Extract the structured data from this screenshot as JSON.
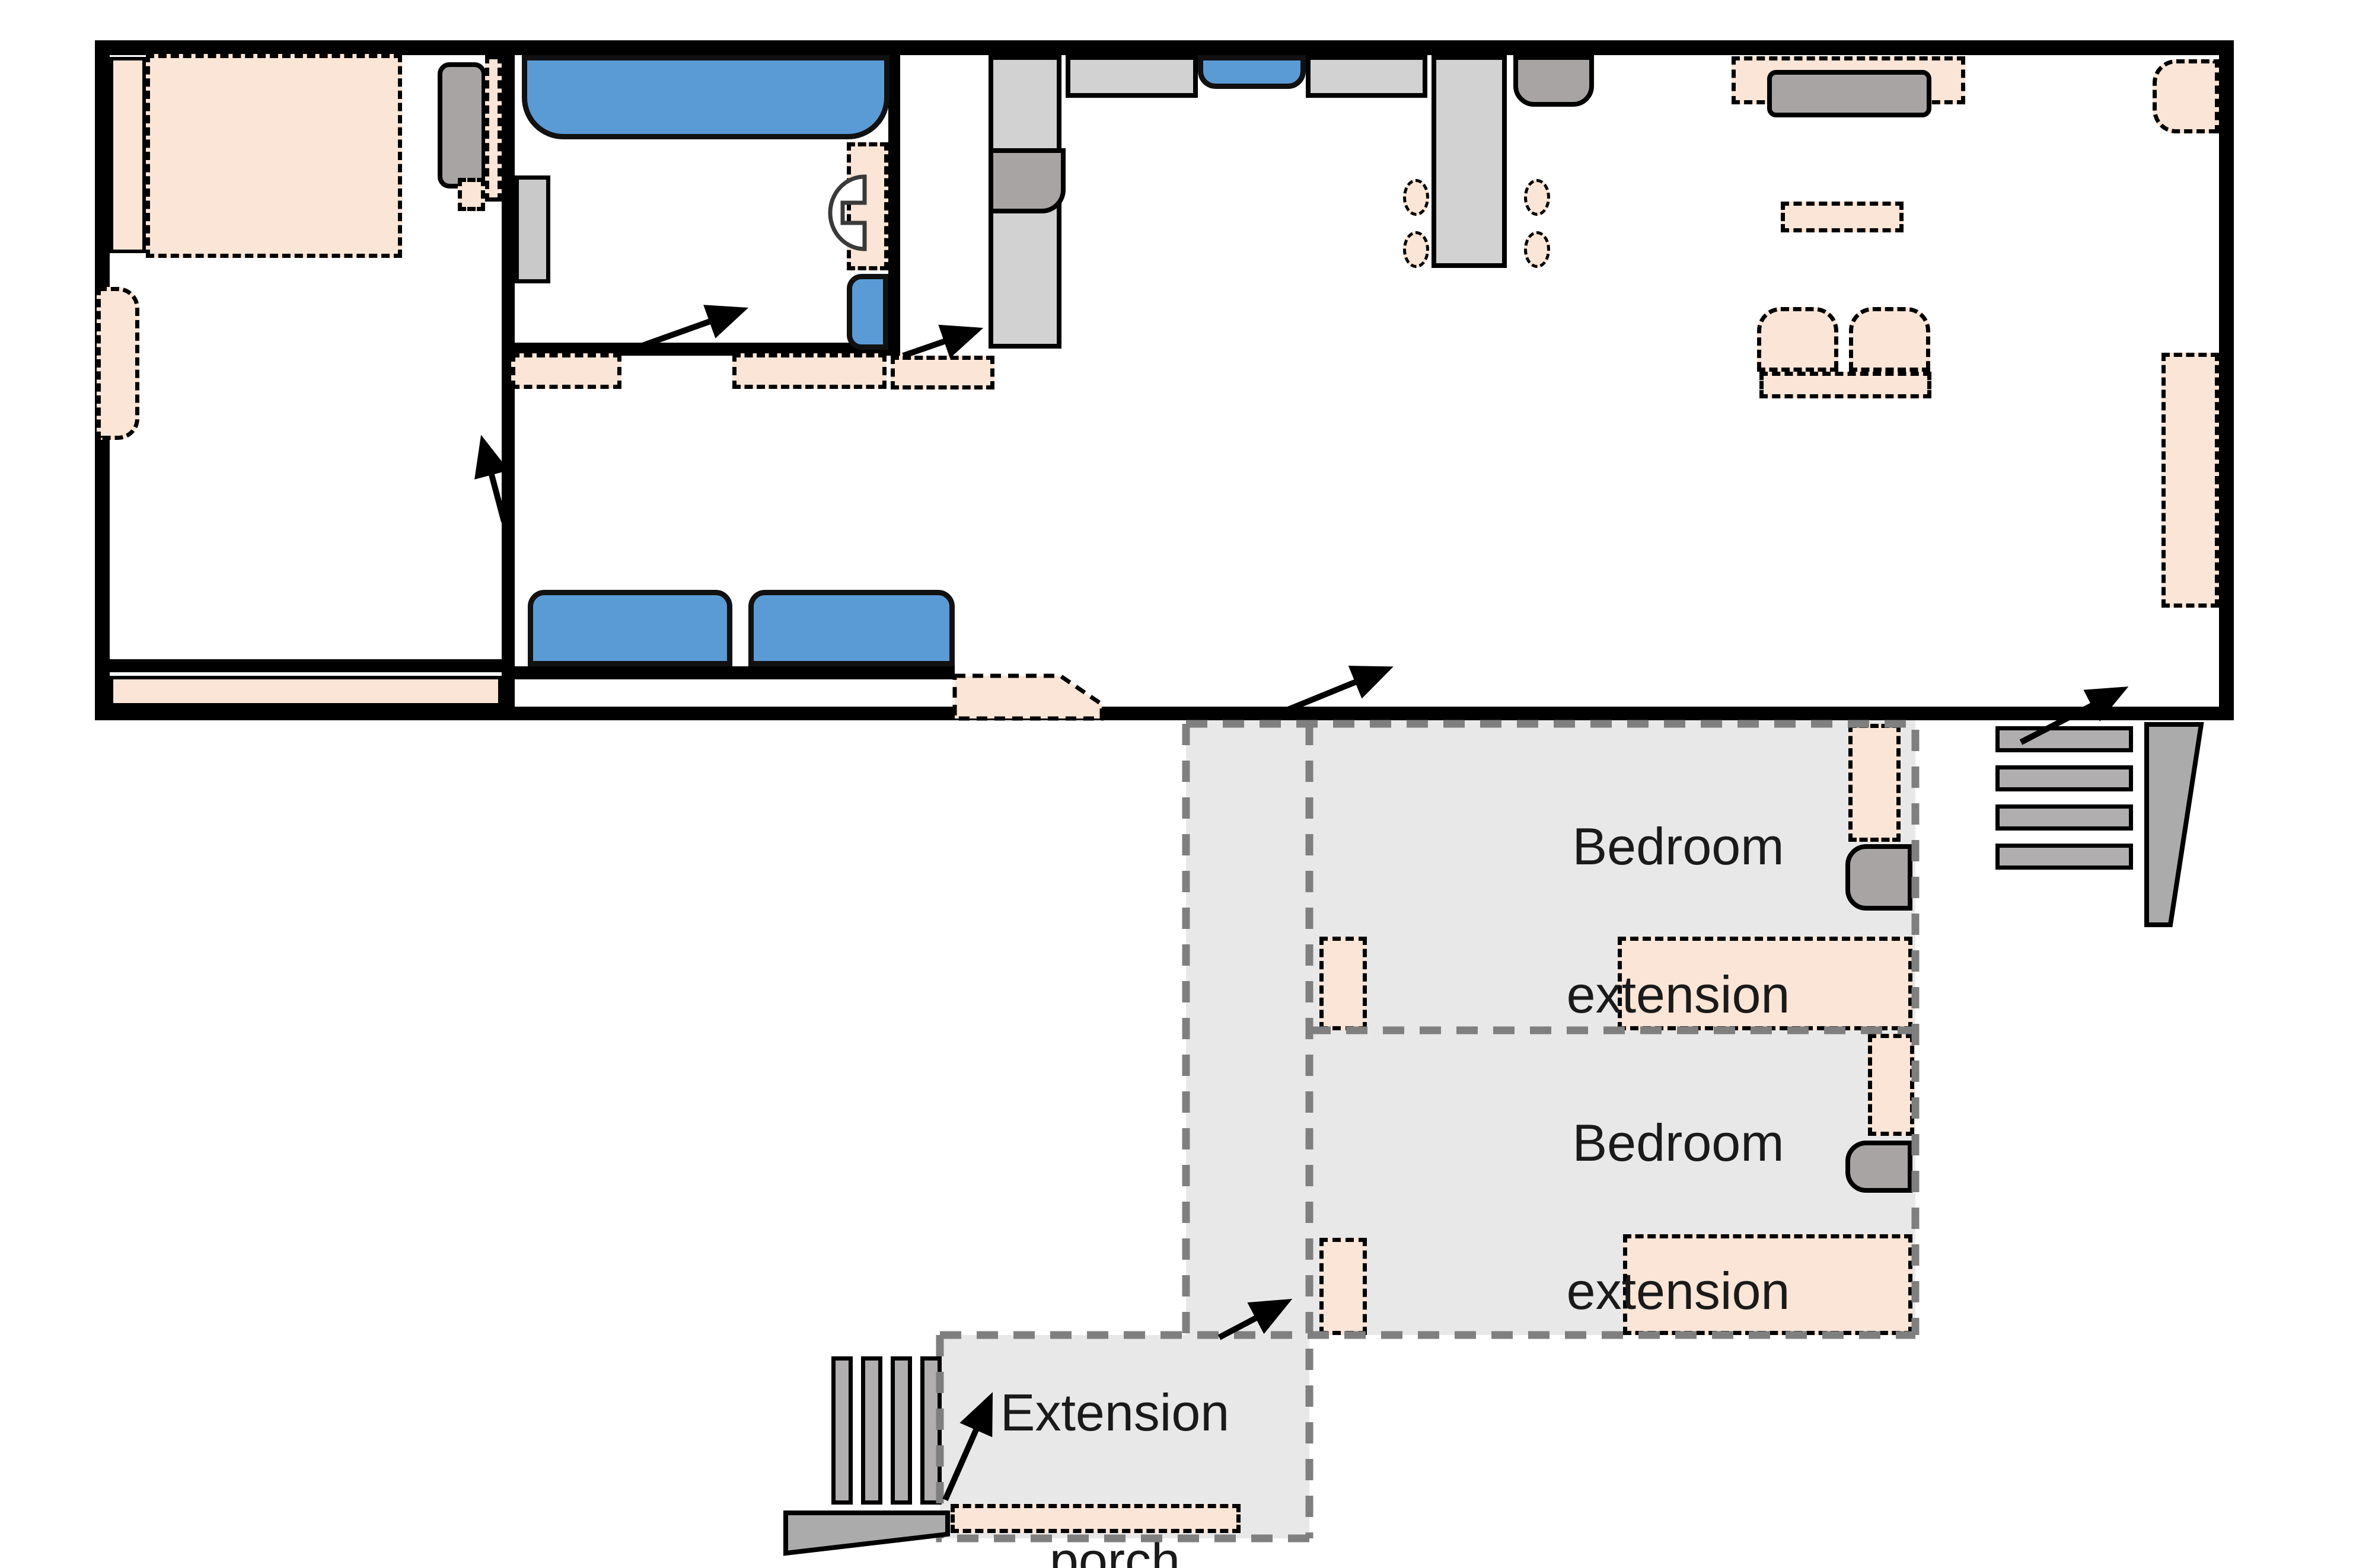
{
  "diagram": {
    "type": "floor-plan",
    "description": "Single-storey house floor plan with grey dashed extension wing",
    "labels": {
      "bedroom_extension_1": {
        "line1": "Bedroom",
        "line2": "extension"
      },
      "bedroom_extension_2": {
        "line1": "Bedroom",
        "line2": "extension"
      },
      "extension_porch": {
        "line1": "Extension",
        "line2": "porch"
      }
    },
    "legend_semantics": {
      "peach_dashed": "furniture / soft furnishing (beds, rugs, chairs, mats)",
      "blue": "plumbing & seating fixtures (bathtub, sink, sofa seats)",
      "light_gray": "counters, wardrobe, table",
      "mid_gray": "appliances, TV, steps",
      "gray_dashed_region": "proposed extension (corridor, two bedrooms, porch)",
      "arrows": "entrances / door swing directions"
    },
    "colors": {
      "peach": "#FBE5D6",
      "blue": "#5B9BD5",
      "light_gray": "#D2D2D2",
      "mid_gray": "#A8A4A4",
      "extension_fill": "#E9E8E8",
      "extension_border": "#7F7F7F",
      "wall": "#000000",
      "text": "#1a1a1a"
    },
    "counts": {
      "entrance_arrows": 7,
      "exterior_stairs": 2,
      "bedroom_extensions": 2
    }
  }
}
